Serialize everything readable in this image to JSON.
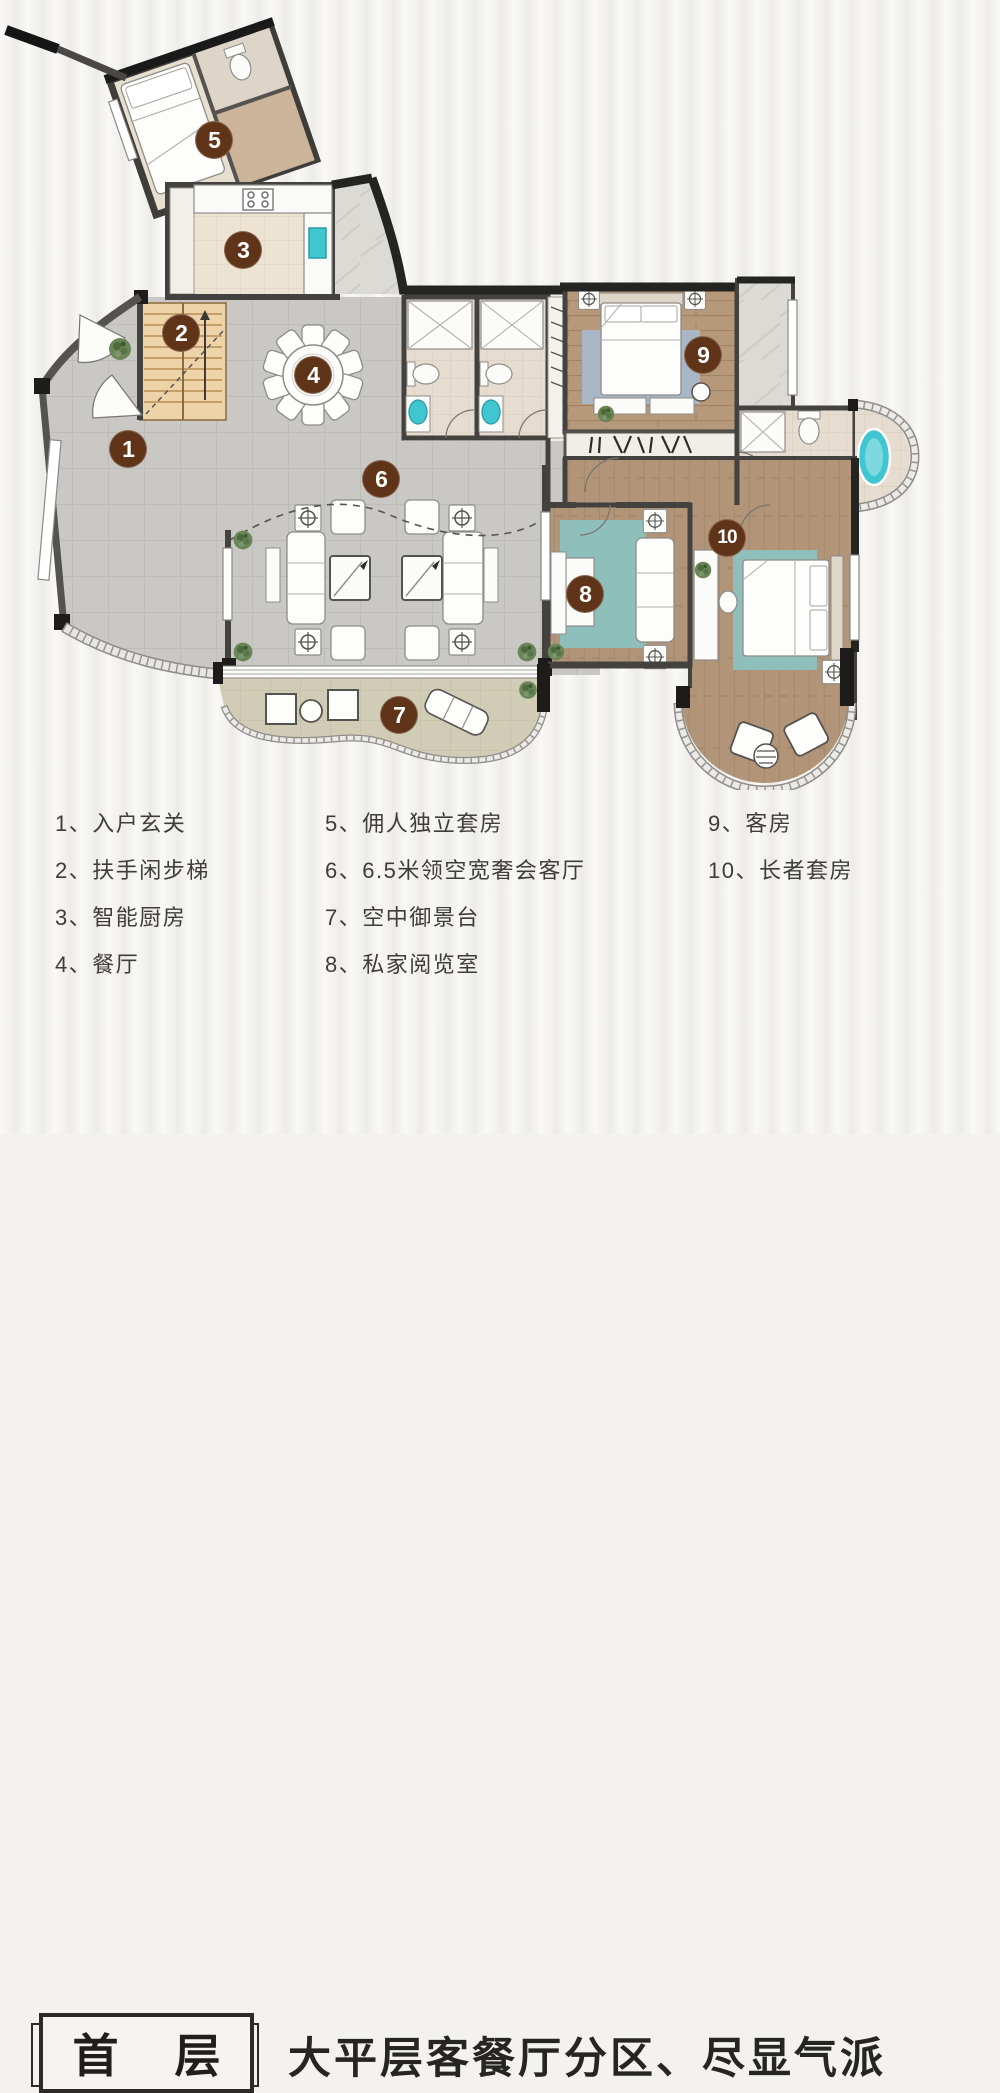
{
  "colors": {
    "badge_bg": "#5f3418",
    "badge_text": "#ffffff",
    "legend_text": "#3f3d3b",
    "caption_text": "#262524",
    "teal_accent": "#3fc6d0",
    "tile_floor": "#c9c8c5",
    "wood_floor": "#b6987a",
    "page_bg": "#f3f2ef"
  },
  "plan": {
    "badges": [
      {
        "number": "1"
      },
      {
        "number": "2"
      },
      {
        "number": "3"
      },
      {
        "number": "4"
      },
      {
        "number": "5"
      },
      {
        "number": "6"
      },
      {
        "number": "7"
      },
      {
        "number": "8"
      },
      {
        "number": "9"
      },
      {
        "number": "10"
      }
    ]
  },
  "legend": {
    "columns": [
      {
        "items": [
          "1、入户玄关",
          "2、扶手闲步梯",
          "3、智能厨房",
          "4、餐厅"
        ]
      },
      {
        "items": [
          "5、佣人独立套房",
          "6、6.5米领空宽奢会客厅",
          "7、空中御景台",
          "8、私家阅览室"
        ]
      },
      {
        "items": [
          "9、客房",
          "10、长者套房"
        ]
      }
    ]
  },
  "footer": {
    "floor_label_chars": [
      "首",
      "层"
    ],
    "caption": "大平层客餐厅分区、尽显气派"
  }
}
